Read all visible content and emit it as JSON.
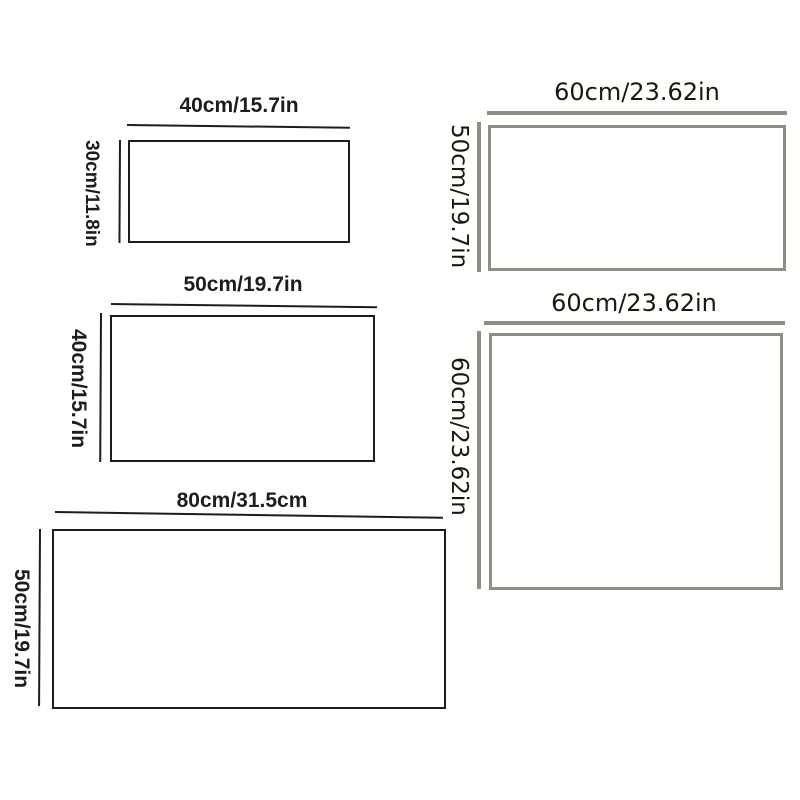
{
  "colors": {
    "ink": "#1d1d1b",
    "gray": "#8e8d89",
    "background": "#fffffe"
  },
  "sizes": [
    {
      "width_label": "40cm/15.7in",
      "height_label": "30cm/11.8in"
    },
    {
      "width_label": "50cm/19.7in",
      "height_label": "40cm/15.7in"
    },
    {
      "width_label": "80cm/31.5cm",
      "height_label": "50cm/19.7in"
    },
    {
      "width_label": "60cm/23.62in",
      "height_label": "50cm/19.7in"
    },
    {
      "width_label": "60cm/23.62in",
      "height_label": "60cm/23.62in"
    }
  ]
}
